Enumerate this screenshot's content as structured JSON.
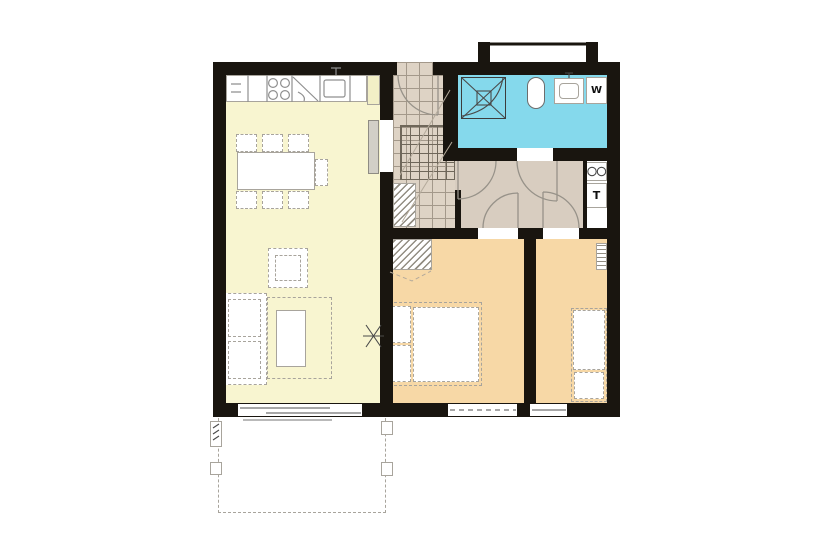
{
  "labels": {
    "washer": "W",
    "dryer": "T"
  },
  "colors": {
    "wall": "#19150f",
    "living": "#f8f5d0",
    "bedroom": "#f7d8a6",
    "bathroom": "#85d9ec",
    "hallway": "#d8cdc0",
    "tiles": "#ded3c5",
    "tile_line": "#a3988a",
    "cabinet": "#f2efc6",
    "line": "#8f8f8f",
    "dash": "#a8a49c"
  },
  "rooms": {
    "living_dining_kitchen": "living-dining-kitchen",
    "vestibule": "tiled-entrance-hall",
    "bathroom": "bathroom",
    "hallway": "hallway",
    "bedroom_1": "bedroom-1",
    "bedroom_2": "bedroom-2",
    "terrace": "terrace"
  }
}
